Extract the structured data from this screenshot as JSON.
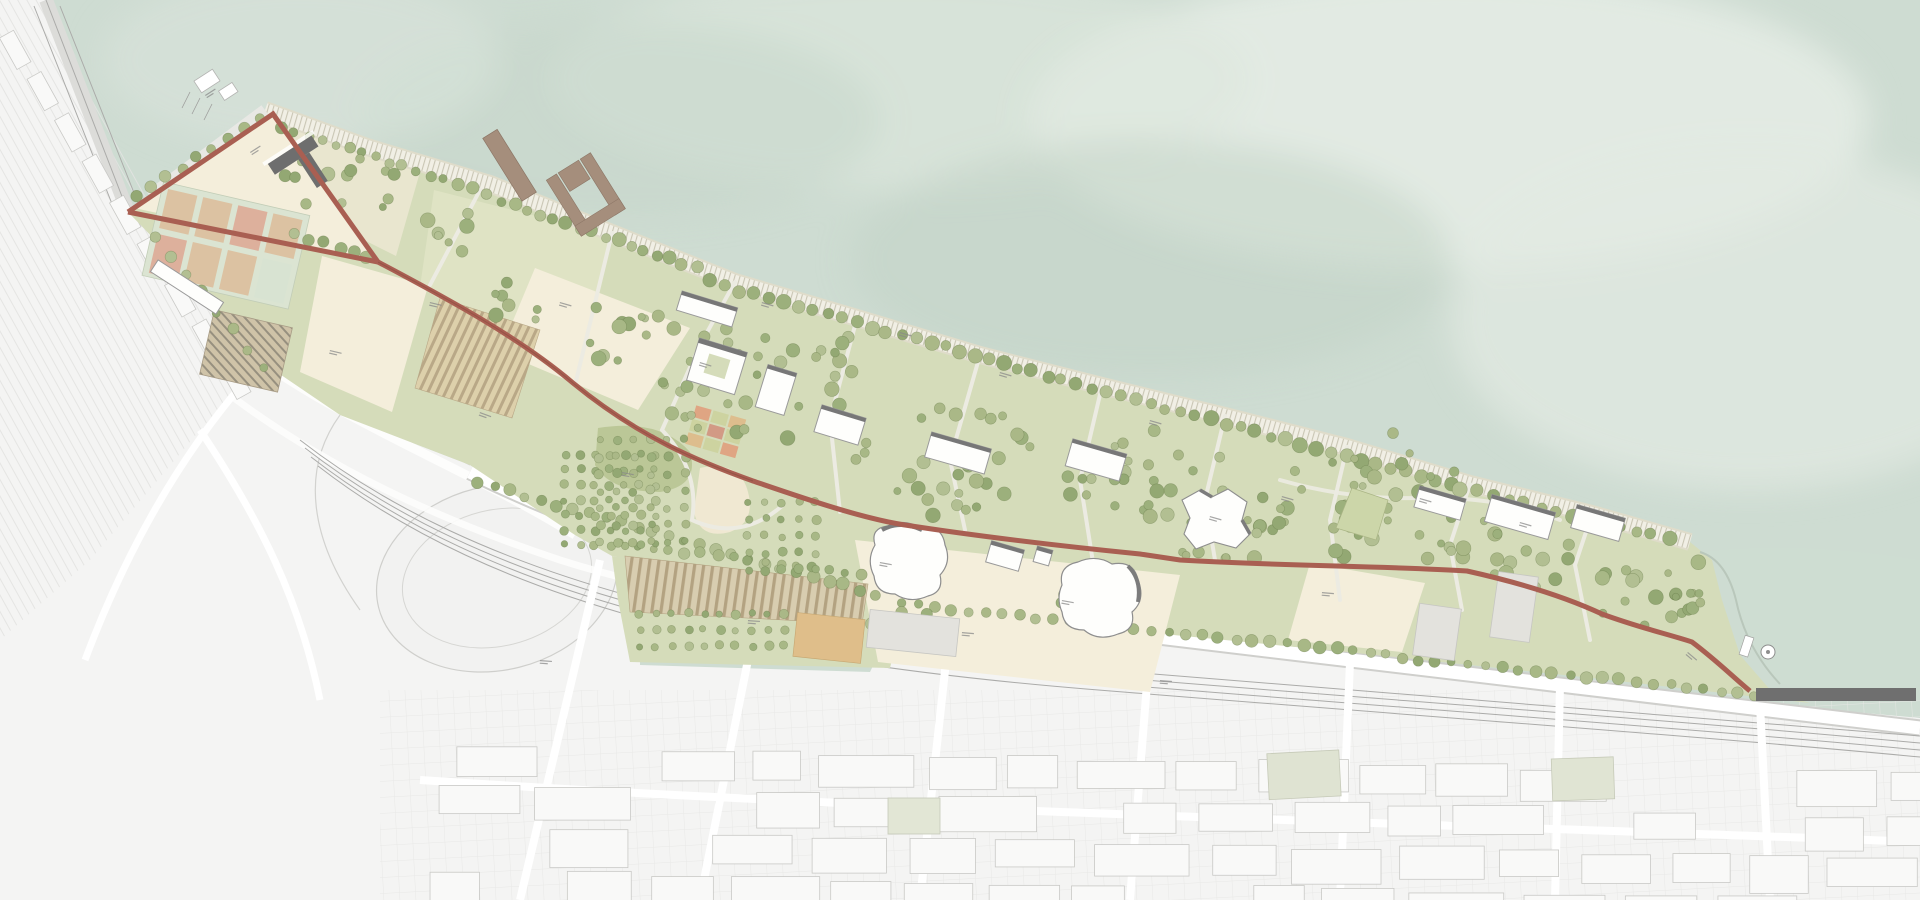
{
  "document": {
    "kind": "waterfront park masterplan site drawing",
    "visible_text_note": "all plan annotations are micro-scale illegible leader-line labels",
    "orientation": "water at top, existing city in grey at bottom-left"
  },
  "palette": {
    "water": "#cedcd2",
    "water_light": "#e7ede7",
    "water_shadow": "#c2d3c6",
    "city": "#f4f4f3",
    "city_line": "#e2e2e0",
    "road": "#ffffff",
    "park": "#d5dcba",
    "lawn_light": "#dfe3c4",
    "meadow_dark": "#b8c494",
    "terrace": "#e9e6cf",
    "cream": "#f4eedb",
    "tree": "#a4b585",
    "tree_dark": "#8fa871",
    "boardwalk": "#f1efe5",
    "boardwalk_line": "#c6c2b0",
    "promenade": "#a95f52",
    "pier": "#a58e7c",
    "pier_deck": "#6f6f6f",
    "building": "#fefefc",
    "building_stroke": "#9a9a9a",
    "building_shadow": "#777777",
    "court": "#d8e3d2",
    "court_tan": "#dcc2a2",
    "court_pink": "#ddb09c",
    "allotment": "#d9cdaa",
    "allotment_line": "#b5a384",
    "sand": "#f0e8d2",
    "orange_patch": "#dfbe8a",
    "path": "#ecebe2",
    "label": "#8a8a8a",
    "green_block": "#dfe3d2"
  },
  "features": [
    {
      "id": "sea",
      "name": "sea-water"
    },
    {
      "id": "city",
      "name": "existing-city-context"
    },
    {
      "id": "interchange",
      "name": "highway-roundabout-interchange"
    },
    {
      "id": "park",
      "name": "waterfront-park"
    },
    {
      "id": "boardwalk",
      "name": "waterfront-boardwalk"
    },
    {
      "id": "promenade",
      "name": "red-promenade-loop"
    },
    {
      "id": "triangle-plaza",
      "name": "entry-triangle-plaza"
    },
    {
      "id": "courts",
      "name": "sports-courts"
    },
    {
      "id": "allotments",
      "name": "allotment-garden-grids"
    },
    {
      "id": "piers",
      "name": "harbor-piers"
    },
    {
      "id": "pavilions",
      "name": "park-pavilion-buildings"
    },
    {
      "id": "halls",
      "name": "organic-hall-buildings"
    },
    {
      "id": "cove",
      "name": "eastern-cove-and-pier"
    }
  ]
}
